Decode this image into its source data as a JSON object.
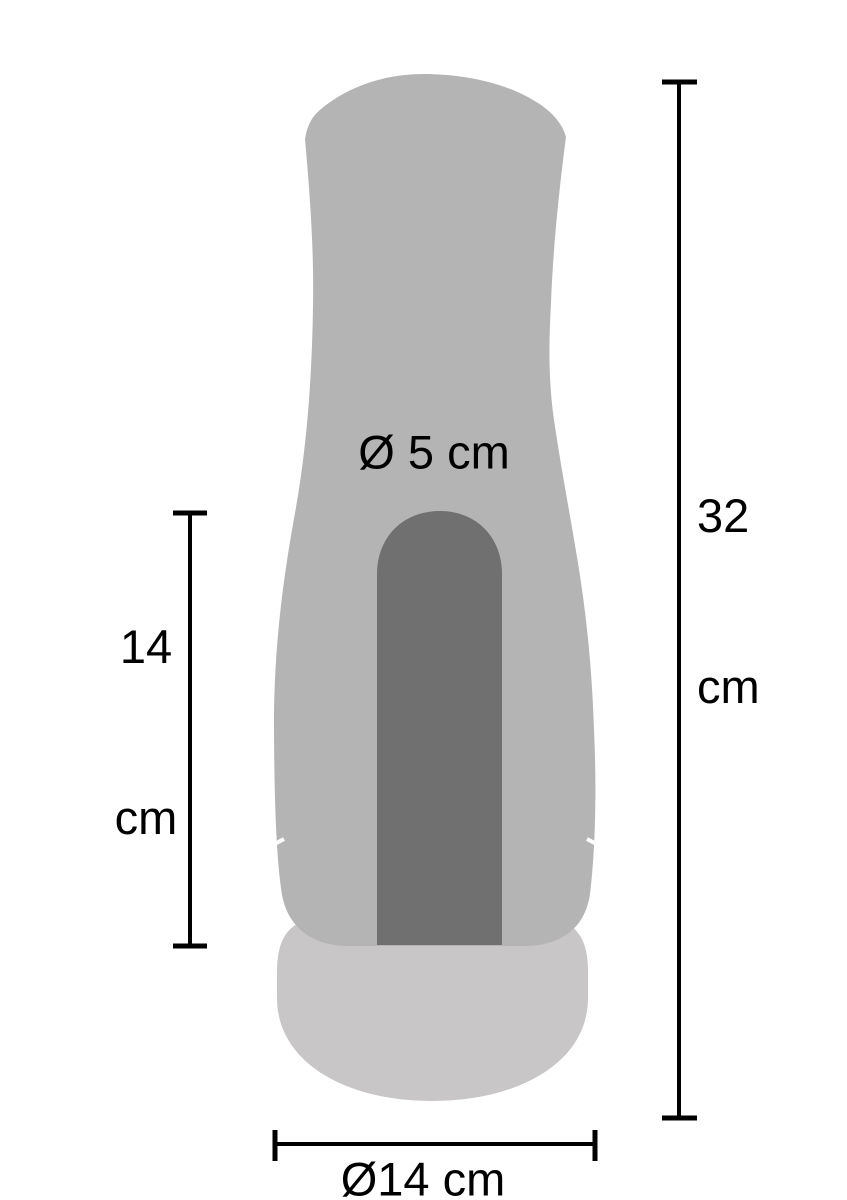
{
  "page": {
    "background": "#ffffff"
  },
  "diagram": {
    "type": "product-size-diagram",
    "colors": {
      "body": "#b4b4b4",
      "opening": "#707070",
      "base": "#c8c6c6",
      "dimension_lines": "#000000",
      "text": "#000000"
    },
    "measurements": {
      "inner_diameter": {
        "label": "Ø 5 cm",
        "value_cm": 5
      },
      "inner_length": {
        "label": "14 cm",
        "line1": "14",
        "line2": "cm",
        "value_cm": 14
      },
      "total_length": {
        "label": "32 cm",
        "line1": "32",
        "line2": "cm",
        "value_cm": 32
      },
      "outer_diameter": {
        "label": "Ø14 cm",
        "value_cm": 14
      }
    }
  }
}
